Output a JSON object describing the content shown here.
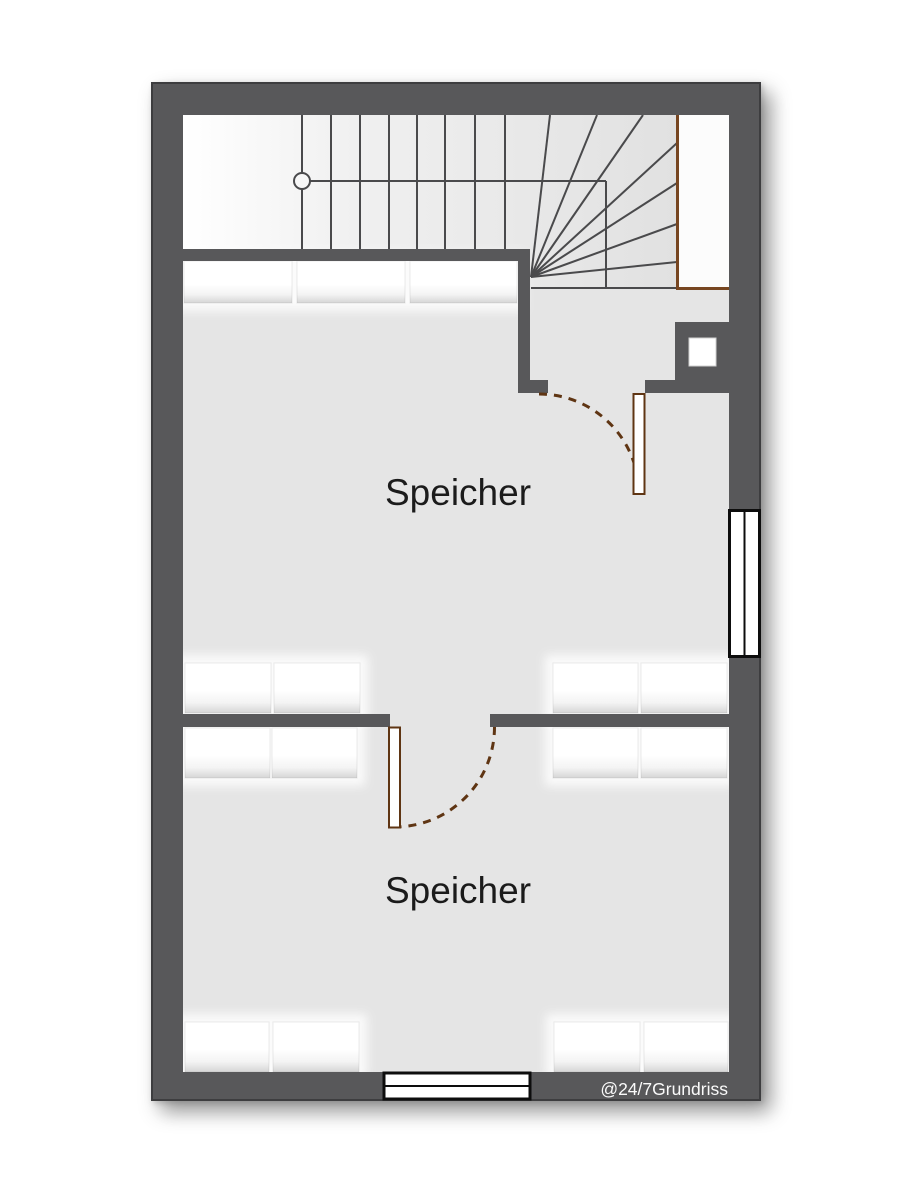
{
  "plan": {
    "title": "Grundriss Dachgeschoss",
    "rooms": [
      {
        "name": "Speicher"
      },
      {
        "name": "Speicher"
      }
    ],
    "watermark": "@24/7Grundriss",
    "features": {
      "staircase": "winder-staircase",
      "door_count": 2,
      "window_count": 2,
      "chimney_count": 1
    },
    "colors": {
      "wall": "#58585a",
      "floor": "#e5e5e5",
      "stair_line": "#4a4a4c",
      "wood": "#5f3513",
      "landing_wood": "#774621",
      "window_frame": "#0d0d0d",
      "label_text": "#1b1b1b",
      "watermark_text": "#fafafa"
    }
  }
}
